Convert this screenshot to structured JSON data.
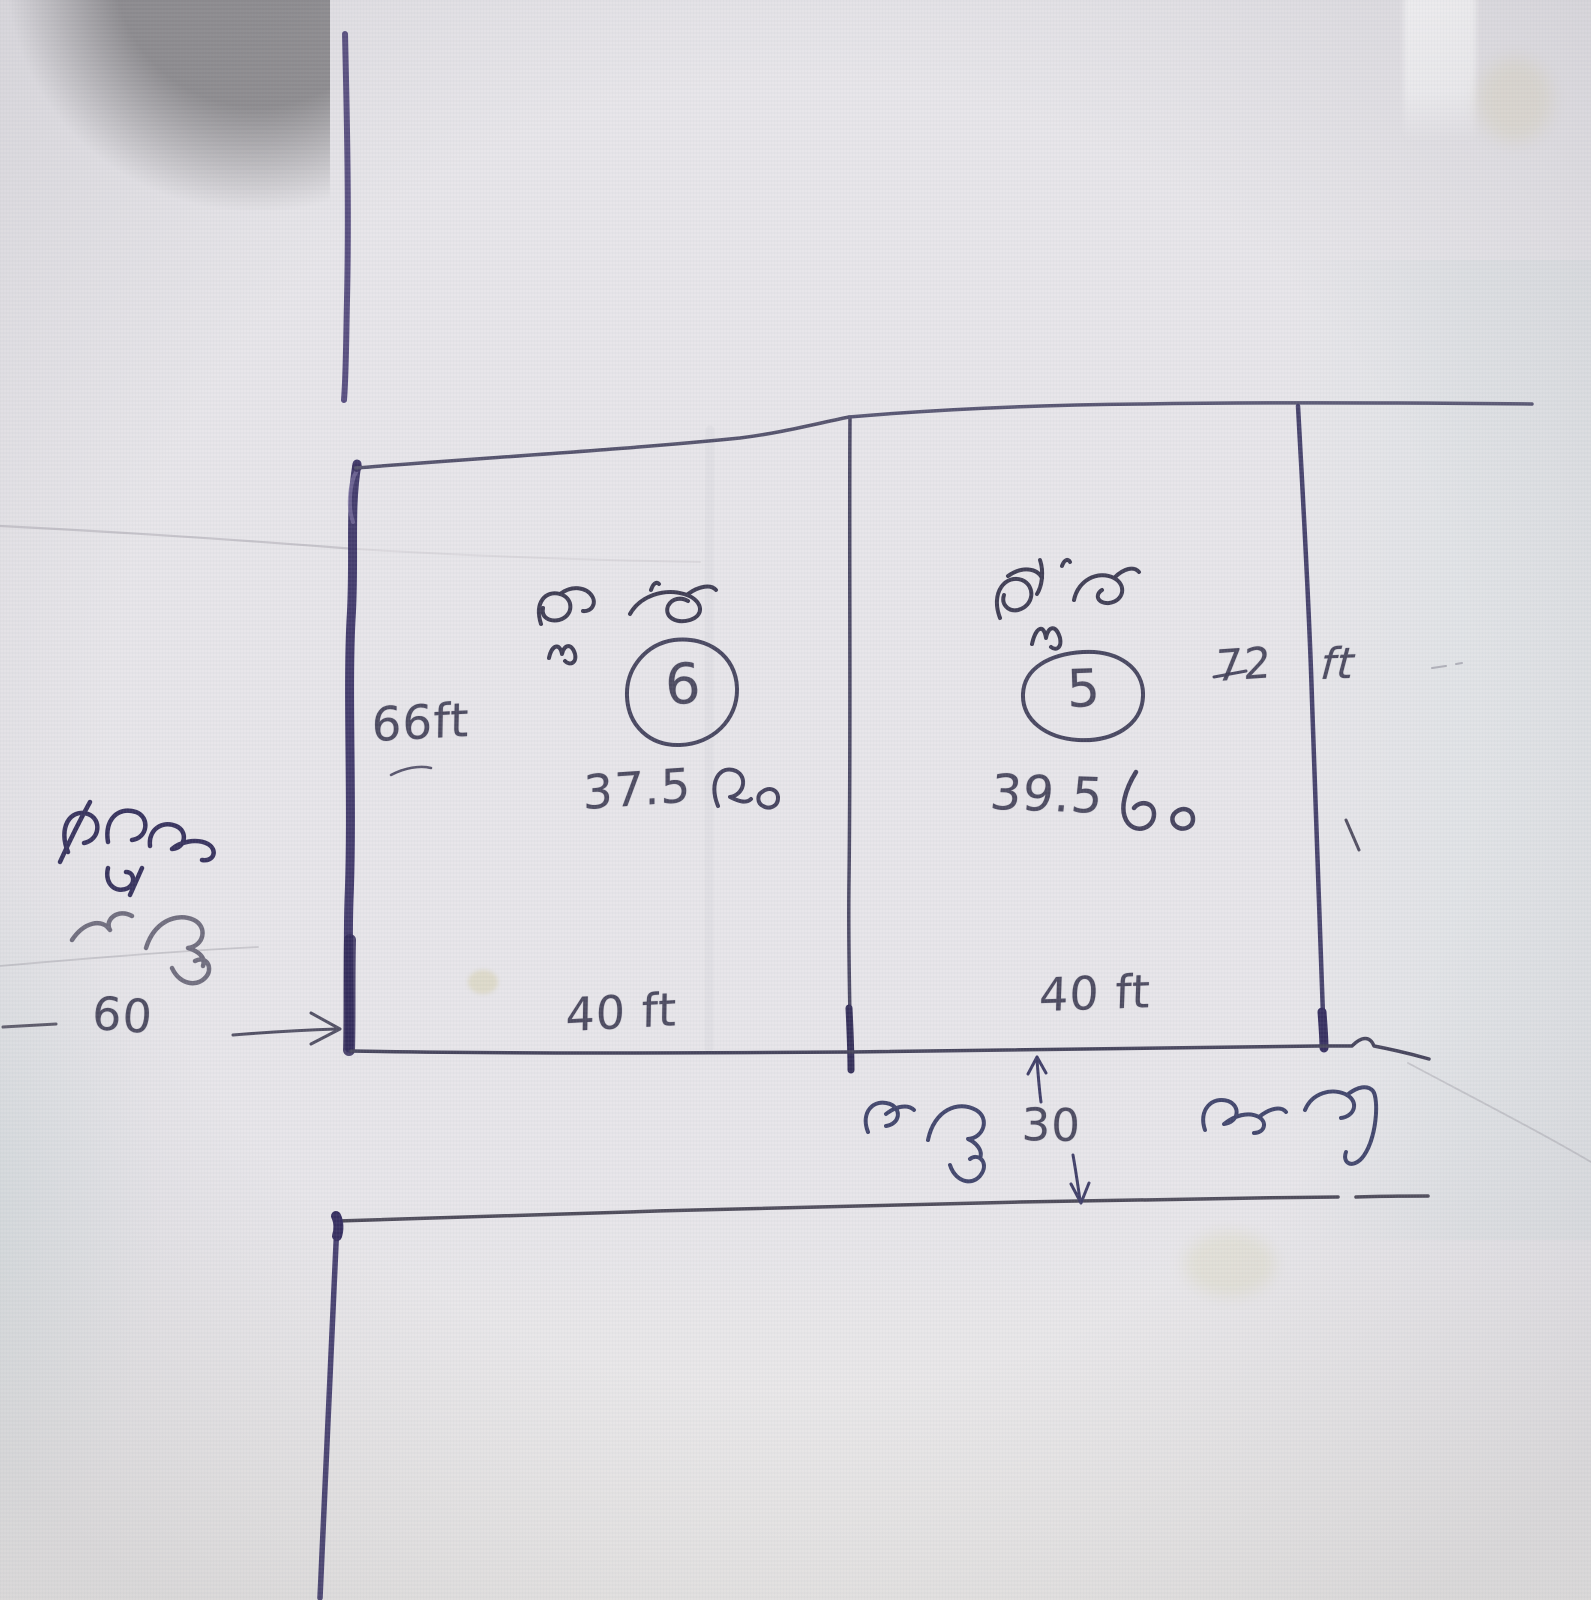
{
  "sketch": {
    "plot_left": {
      "name_telugu": "ప్లాట్",
      "number": "6",
      "area_value": "37.5",
      "area_unit_telugu": "లం",
      "side_label": "66ft",
      "front_label": "40 ft"
    },
    "plot_right": {
      "name_telugu": "ప్లాట్",
      "number": "5",
      "area_value": "39.5",
      "area_unit_telugu": "లం",
      "side_value": "72",
      "side_unit": "ft",
      "front_label": "40 ft"
    },
    "left_road": {
      "line1_telugu": "డ్రైనం",
      "name_telugu": "రోడ్డు",
      "width_value": "60"
    },
    "bottom_road": {
      "name_telugu": "రోడ్డు",
      "width_value": "30",
      "unit_telugu": "మాట్లు"
    },
    "ink_colors": {
      "pen": "#3f3c58",
      "thick_purple": "#382f63",
      "handwriting": "#3a3850"
    }
  }
}
